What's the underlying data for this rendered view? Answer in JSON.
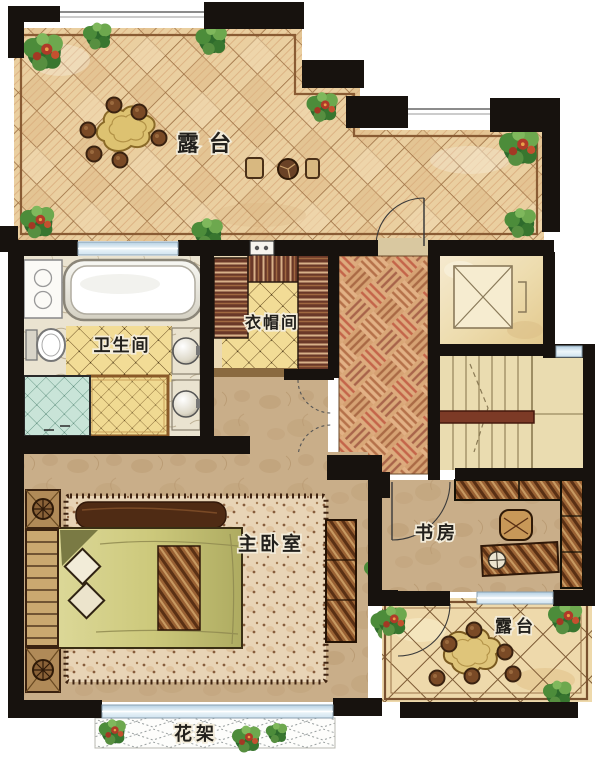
{
  "plan": {
    "type": "residential-floor-plan",
    "style": "hand-drawn watercolor"
  },
  "rooms": {
    "terrace_top": {
      "label": "露台"
    },
    "bathroom": {
      "label": "卫生间"
    },
    "cloakroom": {
      "label": "衣帽间"
    },
    "master_bedroom": {
      "label": "主卧室"
    },
    "study": {
      "label": "书房"
    },
    "terrace_bottom": {
      "label": "露台"
    },
    "flower_rack": {
      "label": "花架"
    }
  },
  "colors": {
    "wall": "#17120e",
    "terrace_tile": "#eacfa0",
    "tile_grout": "#9a6c40",
    "bathroom_tile": "#f2dc96",
    "shower_tile": "#c9e4d8",
    "parquet_light": "#e2b185",
    "parquet_stripe": "#b5714a",
    "wood_dark": "#5a3014",
    "wardrobe": "#6a3828",
    "bedroom_floor": "#c9ae89",
    "rug": "#e8d4b6",
    "duvet": "#cdc97c",
    "stair_tread": "#eadcb0",
    "handrail": "#7c3a26",
    "elevator_floor": "#efe0b6",
    "window_glass": "#bcd4e4",
    "plant_green": "#2e6b2c",
    "flower_red": "#b03a28",
    "parapet": "#8a5c34",
    "label_text": "#22201c"
  }
}
